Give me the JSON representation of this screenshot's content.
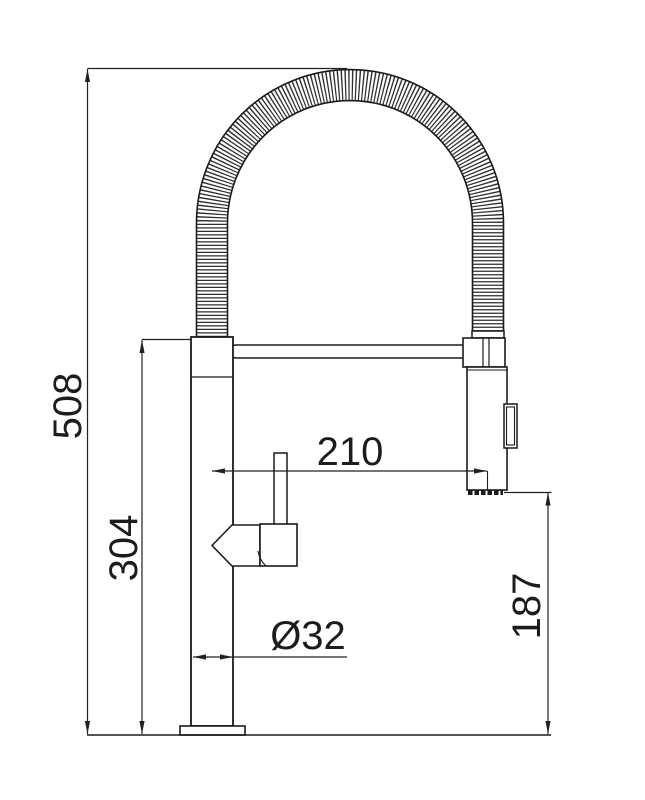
{
  "document": {
    "title": "Kitchen faucet dimensional drawing",
    "view": "side elevation",
    "units": "mm"
  },
  "dimensions": {
    "overall_height": "508",
    "body_height": "304",
    "spout_reach": "210",
    "base_diameter": "Ø32",
    "spray_outlet_clearance": "187"
  },
  "colors": {
    "line": "#1a1a1a",
    "dimension_line": "#222222",
    "background": "#ffffff"
  }
}
